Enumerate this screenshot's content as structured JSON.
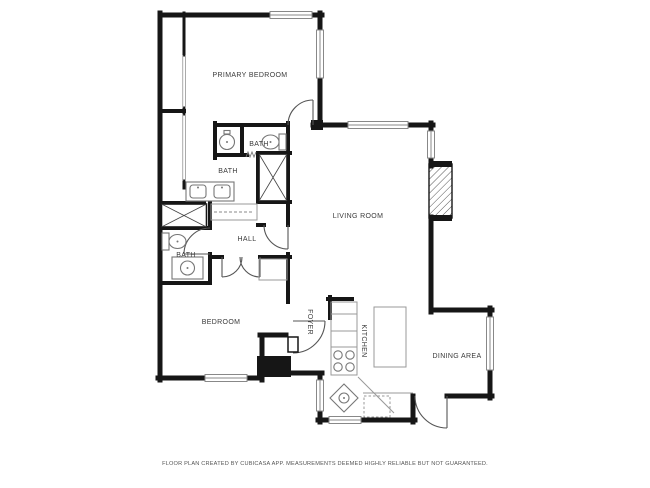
{
  "floor_plan": {
    "rooms": {
      "primary_bedroom": "PRIMARY BEDROOM",
      "bath_primary": "BATH",
      "bath_main": "BATH",
      "hall": "HALL",
      "bath_lower": "BATH",
      "bedroom": "BEDROOM",
      "living_room": "LIVING ROOM",
      "foyer": "FOYER",
      "kitchen": "KITCHEN",
      "dining_area": "DINING AREA"
    },
    "footer": "FLOOR PLAN CREATED BY CUBICASA APP. MEASUREMENTS DEEMED HIGHLY RELIABLE BUT NOT GUARANTEED.",
    "colors": {
      "wall": "#161616",
      "fixture_outline": "#777777",
      "door_swing": "#555555",
      "label_text": "#3a3a3a",
      "footer_text": "#555555",
      "background": "#ffffff"
    }
  }
}
